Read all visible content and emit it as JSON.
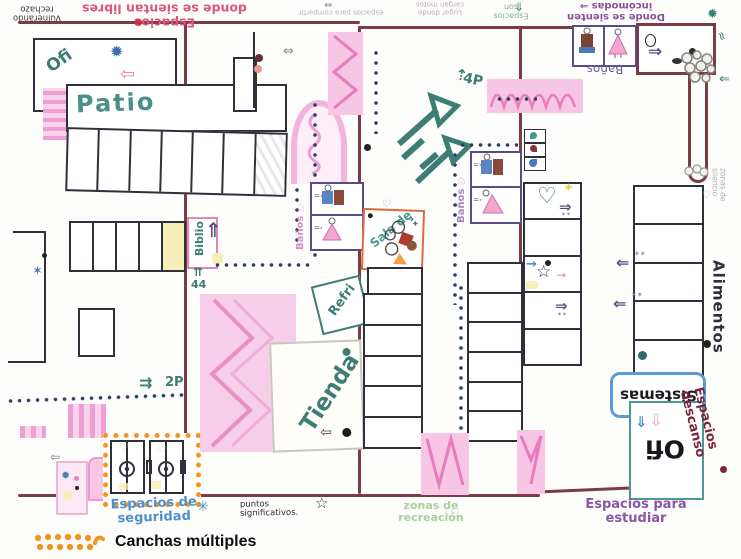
{
  "colors": {
    "maroon": "#7e3b46",
    "teal": "#3d7d74",
    "pink": "#e87bbd",
    "purple": "#5b4a8a",
    "blue": "#4f8fcc",
    "orange": "#f5941e",
    "green": "#a8cf9e",
    "violet": "#8a56a8"
  },
  "icons": {
    "arrow_up": "⇑",
    "arrow_right": "⇒",
    "arrow_left": "⇐",
    "arrow_down": "⇓",
    "arrow_down_outline": "⇩",
    "arrow_left_outline": "⇦",
    "arrow_lr_outline": "⇔",
    "arrow_double_right": "⇉",
    "arrow_up_pair": "⇈",
    "arrow_up_small": "⇡",
    "arrow_right_small": "→",
    "star_outline": "☆",
    "asterisk": "✳",
    "splat": "✹",
    "sparkle": "✶",
    "sparkle_pair": "✶✶",
    "star4": "✦",
    "heart": "♡",
    "squiggle": "≈"
  },
  "map": {
    "top": {
      "vulnerando": "Vulnerando\nrechazo",
      "libres": "Espacios\ndonde se sientan libres",
      "compartir": "espacios para compartir",
      "motos": "Lugar donde\ncargan motos",
      "donde": "Donde se sienten\nincómodas ⇒",
      "esp_verde": "Espacios son",
      "banos_top": "Baños"
    },
    "left": {
      "ofi": "Ofi",
      "patio": "Patio",
      "p2": "2P",
      "seguridad": "Espacios de\nseguridad"
    },
    "middle": {
      "biblio": "Biblio",
      "n44": "44",
      "banos1": "Baños ♡",
      "banos2": "Baños ♡",
      "sala": "Sala de",
      "refri": "Refri",
      "tienda": "Tienda",
      "p4": "4P"
    },
    "bottom": {
      "puntos": "puntos significativos.",
      "recreacion": "zonas de\nrecreación",
      "estudiar": "Espacios para\nestudiar"
    },
    "right": {
      "sistemas": "Sistemas",
      "ofi": "Ofi",
      "alimentos": "Alimentos",
      "descanso": "Espacios\ndescanso",
      "silencio": "zonas de silencio"
    }
  },
  "legend": {
    "label": "Canchas múltiples"
  }
}
